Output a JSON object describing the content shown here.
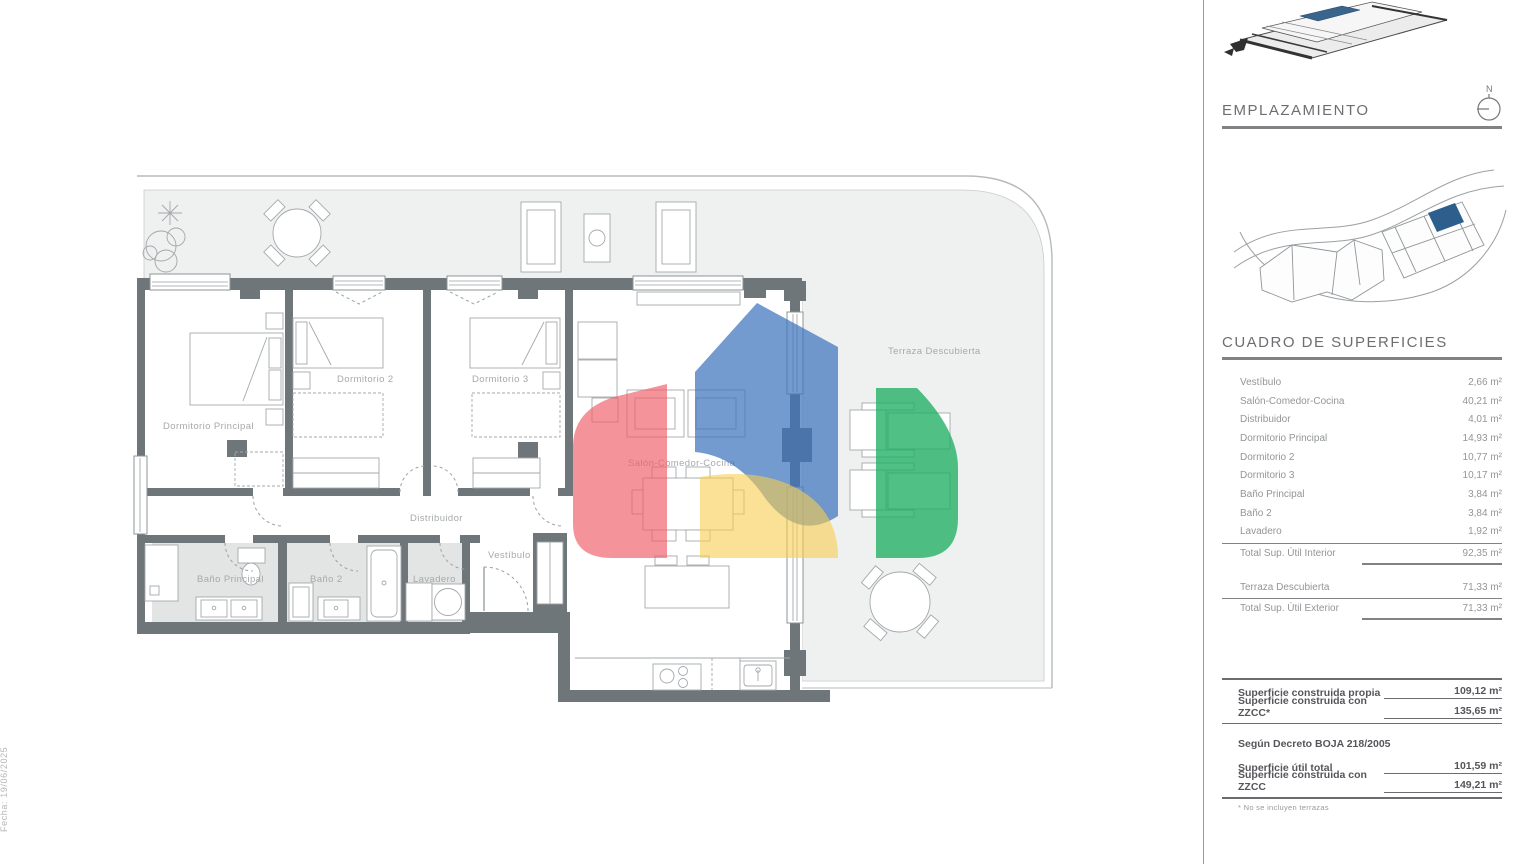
{
  "plan": {
    "rooms": {
      "dormitorio_principal": "Dormitorio Principal",
      "dormitorio2": "Dormitorio 2",
      "dormitorio3": "Dormitorio 3",
      "distribuidor": "Distribuidor",
      "vestibulo": "Vestíbulo",
      "bano_principal": "Baño Principal",
      "bano2": "Baño 2",
      "lavadero": "Lavadero",
      "salon": "Salón-Comedor-Cocina",
      "terraza": "Terraza Descubierta"
    }
  },
  "panel": {
    "emplazamiento_title": "EMPLAZAMIENTO",
    "north_label": "N",
    "cuadro_title": "CUADRO DE SUPERFICIES",
    "surfaces": [
      {
        "label": "Vestíbulo",
        "value": "2,66 m²"
      },
      {
        "label": "Salón-Comedor-Cocina",
        "value": "40,21 m²"
      },
      {
        "label": "Distribuidor",
        "value": "4,01 m²"
      },
      {
        "label": "Dormitorio Principal",
        "value": "14,93 m²"
      },
      {
        "label": "Dormitorio 2",
        "value": "10,77 m²"
      },
      {
        "label": "Dormitorio 3",
        "value": "10,17 m²"
      },
      {
        "label": "Baño Principal",
        "value": "3,84 m²"
      },
      {
        "label": "Baño 2",
        "value": "3,84 m²"
      },
      {
        "label": "Lavadero",
        "value": "1,92 m²"
      }
    ],
    "total_interior": {
      "label": "Total Sup. Útil Interior",
      "value": "92,35 m²"
    },
    "terraza_row": {
      "label": "Terraza Descubierta",
      "value": "71,33 m²"
    },
    "total_exterior": {
      "label": "Total Sup. Útil Exterior",
      "value": "71,33 m²"
    },
    "built": [
      {
        "label": "Superficie construida propia",
        "value": "109,12 m²"
      },
      {
        "label": "Superficie construida con ZZCC*",
        "value": "135,65 m²"
      }
    ],
    "decreto_header": "Según Decreto BOJA 218/2005",
    "decreto": [
      {
        "label": "Superficie útil total",
        "value": "101,59 m²"
      },
      {
        "label": "Superficie construida con ZZCC",
        "value": "149,21 m²"
      }
    ],
    "footnote": "* No se incluyen terrazas"
  },
  "footer": {
    "department": "DEPARTAMENTO TÉCNICO",
    "revision": "Revisión: 02",
    "date": "Fecha: 19/06/2025"
  },
  "colors": {
    "wall": "#6e767a",
    "terrace_fill": "#eff0f0",
    "bath_fill": "#e3e4e4",
    "logo_red": "#ef5d66",
    "logo_blue": "#3f74bc",
    "logo_yellow": "#f6cd4e",
    "logo_green": "#1fae63",
    "site_unit_blue": "#2d5f8d",
    "panel_text": "#939598",
    "panel_bold_text": "#55565a"
  }
}
